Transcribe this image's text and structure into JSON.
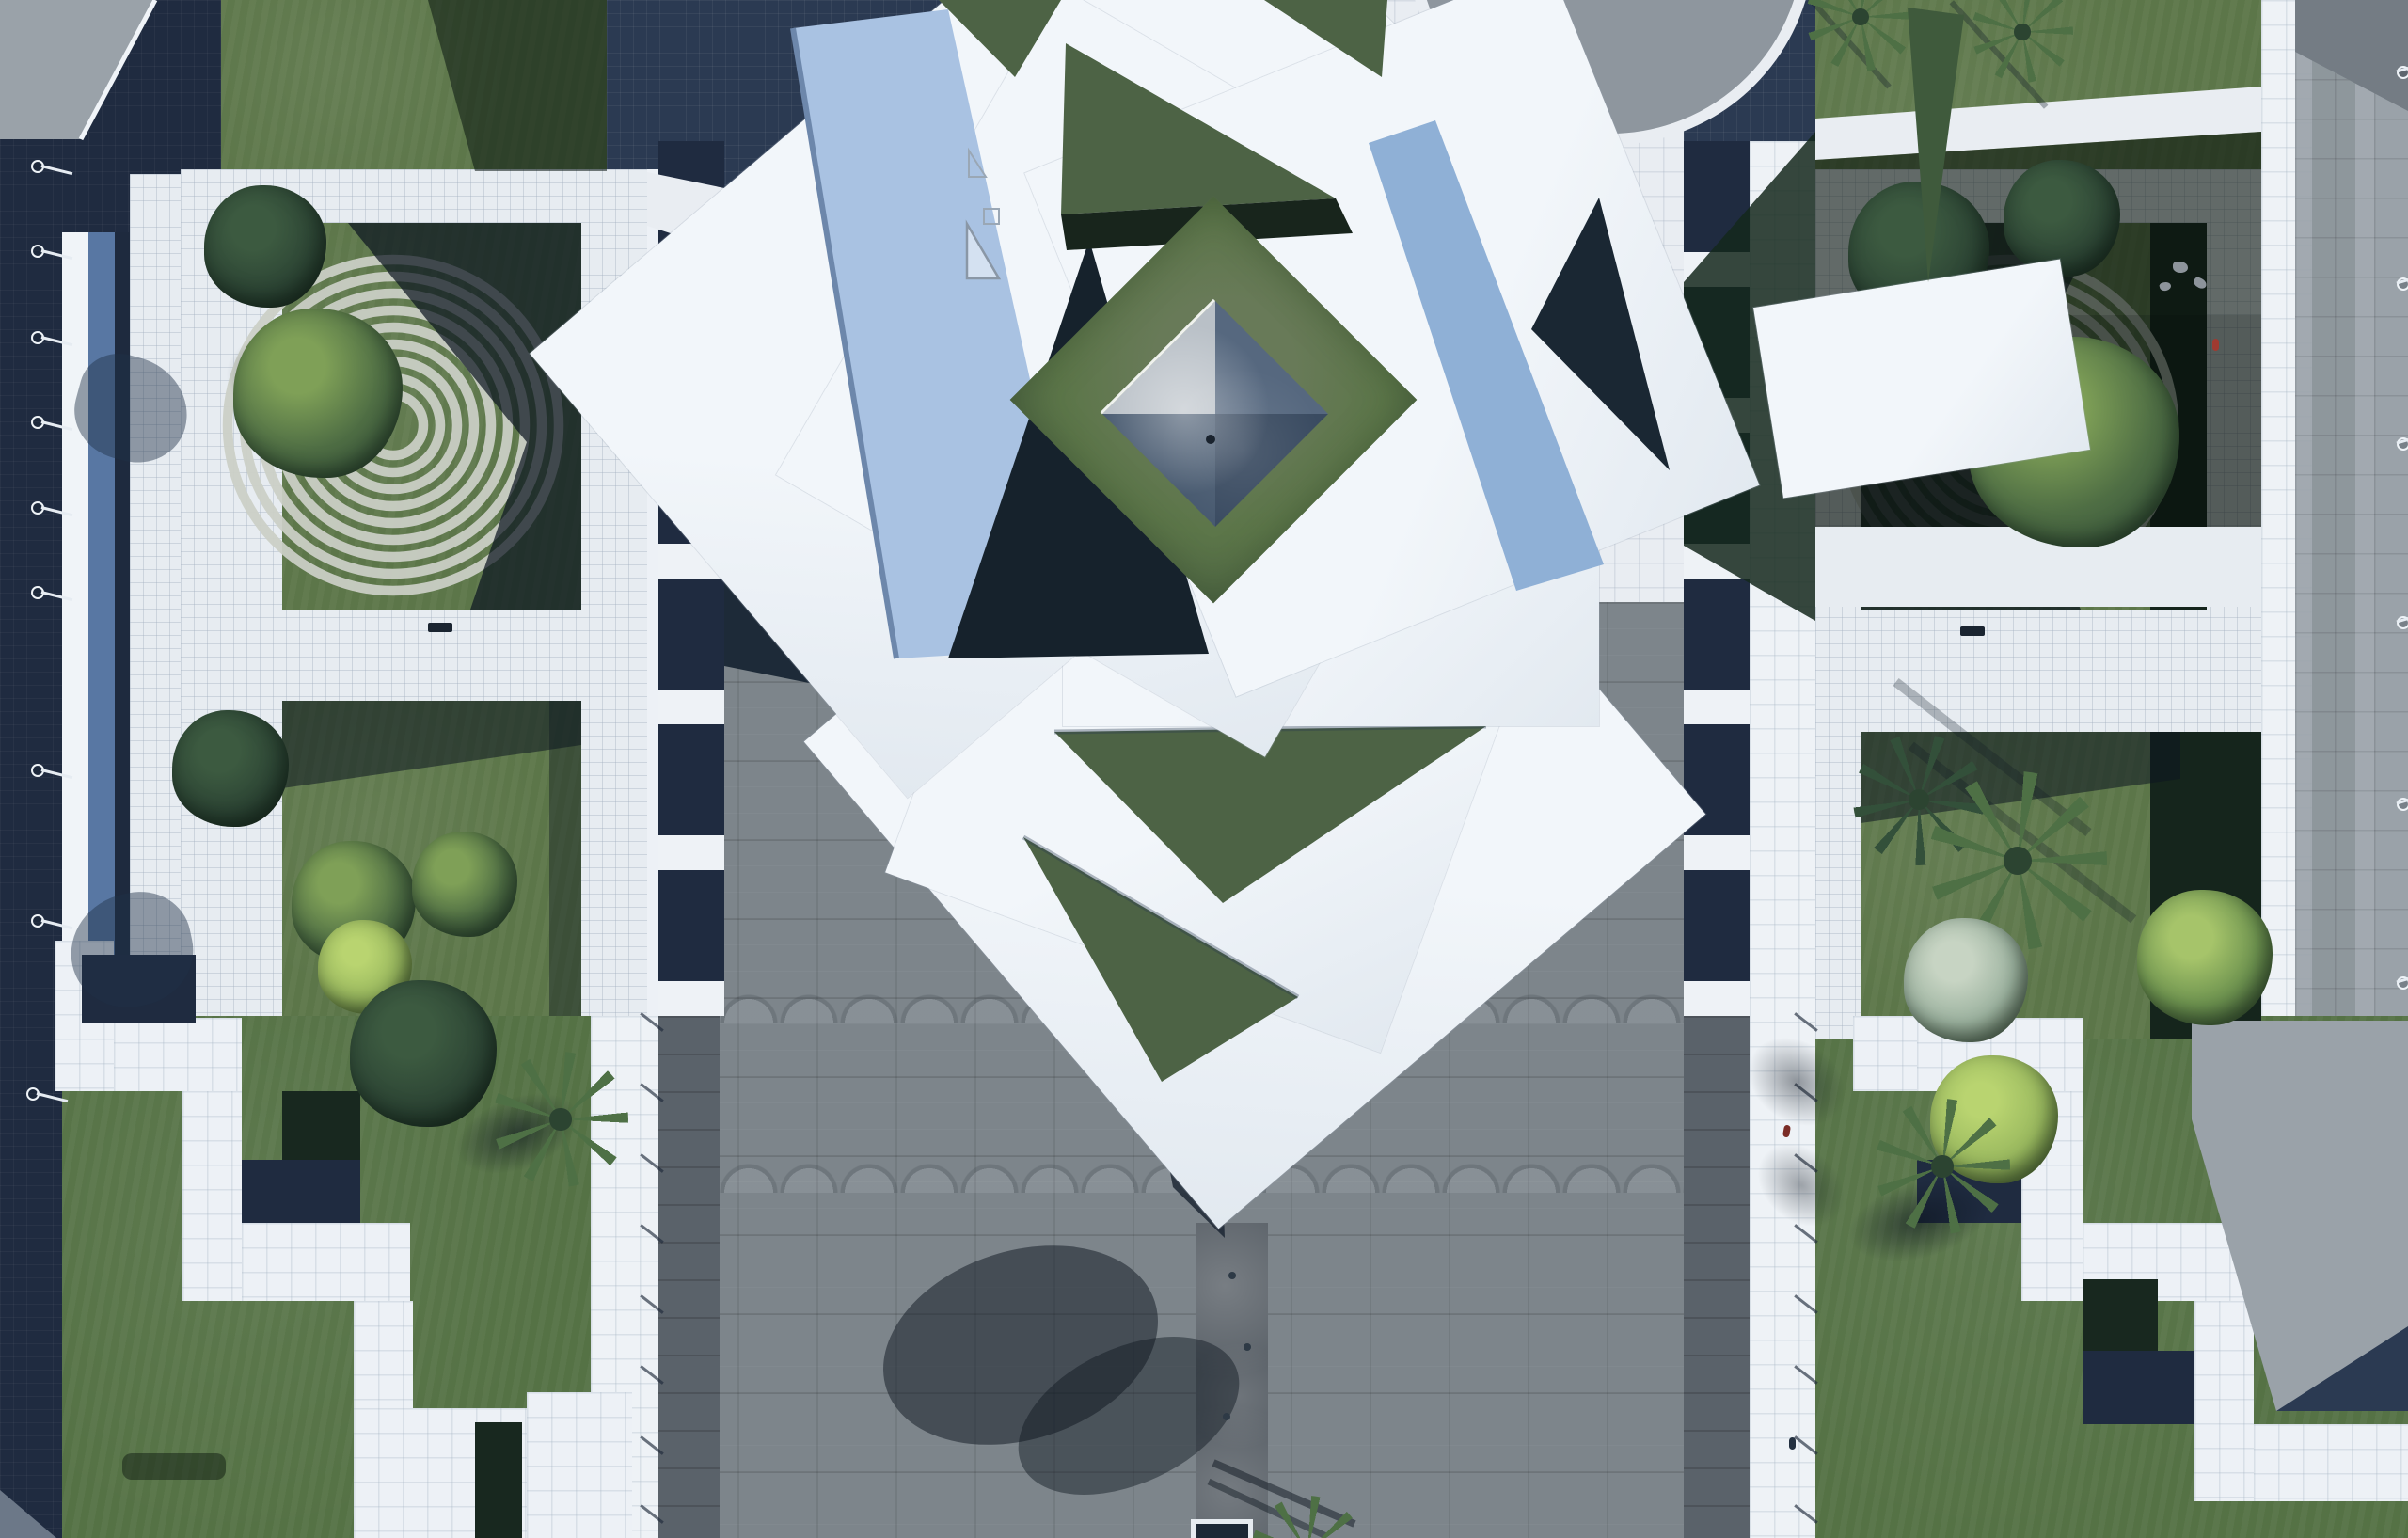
{
  "scene": {
    "name": "aerial-plaza-render",
    "type": "top-down architectural visualization",
    "regions": [
      "left-promenade",
      "left-garden-court",
      "spiral-rock-garden-left",
      "central-pavilion-roof-pinwheel",
      "courtyard-lawn-diamond",
      "glass-pyramid-skylight",
      "great-gray-plaza",
      "water-channel-walk",
      "right-garden-court",
      "spiral-rock-garden-right",
      "palm-grove",
      "stepped-terraces",
      "perimeter-walkways",
      "roof-disc-plaza"
    ],
    "features": {
      "spiral_ring_count": 9,
      "left_edge_lamp_count": 9,
      "right_edge_lamp_count": 6,
      "walkway_tick_count": 8,
      "left_terrace_step_count": 7,
      "right_terrace_step_count": 6
    }
  },
  "colors": {
    "pavement": "#e9edf2",
    "frame-tile": "#e7ecf1",
    "roof-white": "#f2f6fa",
    "roof-shade": "#e2e9f0",
    "facet-blue": "#a9c2e2",
    "facet-blue-deep": "#8fb0d6",
    "navy": "#2b3a52",
    "navy-deep": "#1f2b40",
    "shadow-dark": "#16222c",
    "grass": "#5c7649",
    "grass-bright": "#557245",
    "grass-tri": "#4d6345",
    "grass-dark": "#24342a",
    "grass-shadow": "#18281f",
    "gravel": "#ccd0c7",
    "plaza": "#7d858b",
    "channel": "#5a6168",
    "paving-gray": "#9aa2a9",
    "paving-dark": "#747c84",
    "strip-gray": "#5a626a",
    "steel-blue": "#5877a3",
    "glass-light": "#b9c0c7",
    "glass-ne": "#56687f",
    "glass-se": "#3a4b61",
    "glass-sw": "#47596f",
    "tree": "#4f6e44",
    "tree-light": "#7fa057",
    "tree-lime": "#9ab95f",
    "tree-dark": "#2c4434",
    "palm": "#4e7045",
    "disc-gray": "#8e969e",
    "bench": "#1a2430",
    "person-red": "#a03a30",
    "figure-dark": "#233040"
  }
}
